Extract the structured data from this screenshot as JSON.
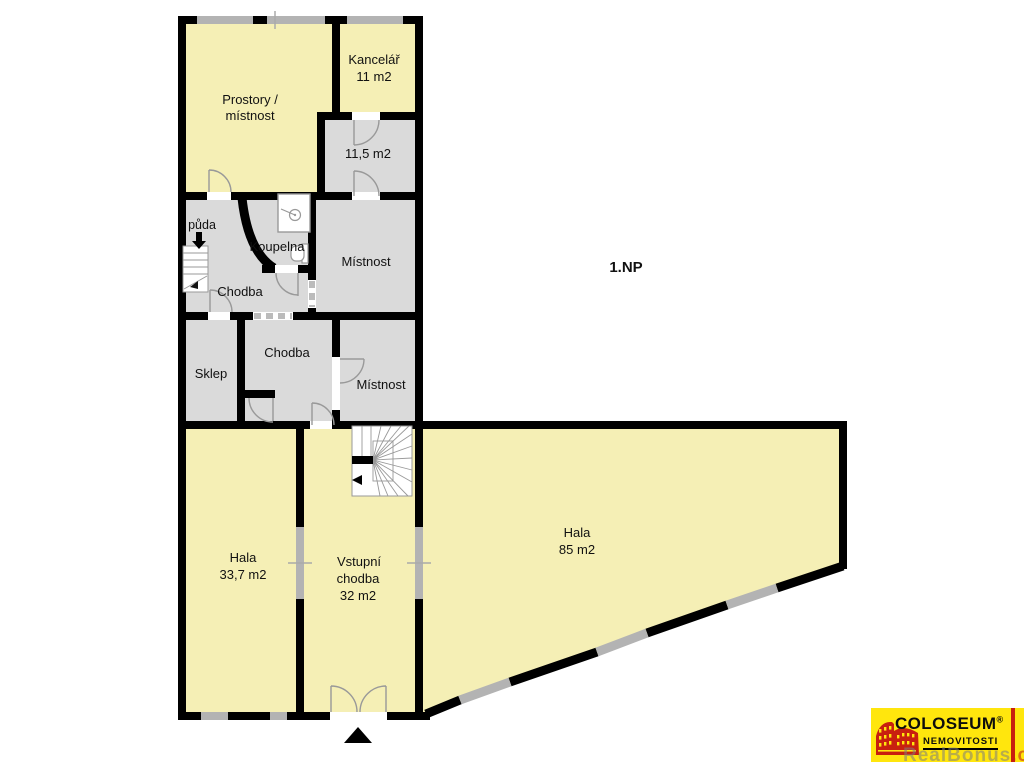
{
  "floor": {
    "label": "1.NP"
  },
  "rooms": {
    "prostory": {
      "line1": "Prostory /",
      "line2": "místnost"
    },
    "kancelar": {
      "name": "Kancelář",
      "area": "11 m2"
    },
    "pokoj115": {
      "area": "11,5 m2"
    },
    "puda": {
      "label": "půda"
    },
    "koupelna": {
      "name": "Koupelna"
    },
    "chodba_horni": {
      "name": "Chodba"
    },
    "mistnost_stredni": {
      "name": "Místnost"
    },
    "sklep": {
      "name": "Sklep"
    },
    "chodba_dolni": {
      "name": "Chodba"
    },
    "mistnost_mala": {
      "name": "Místnost"
    },
    "hala_leva": {
      "name": "Hala",
      "area": "33,7 m2"
    },
    "vstupni_chodba": {
      "line1": "Vstupní",
      "line2": "chodba",
      "area": "32 m2"
    },
    "hala_hlavni": {
      "name": "Hala",
      "area": "85 m2"
    }
  },
  "logo": {
    "brand": "COLOSEUM",
    "registered": "®",
    "subtitle": "NEMOVITOSTI",
    "watermark": "RealBonus",
    "watermark_suffix": ".cz"
  },
  "colors": {
    "room_fill_yellow": "#f5efb5",
    "room_fill_gray": "#dadada",
    "wall": "#000000",
    "window": "#b3b3b3",
    "logo_bg": "#ffe60d",
    "logo_red": "#c8200f"
  }
}
